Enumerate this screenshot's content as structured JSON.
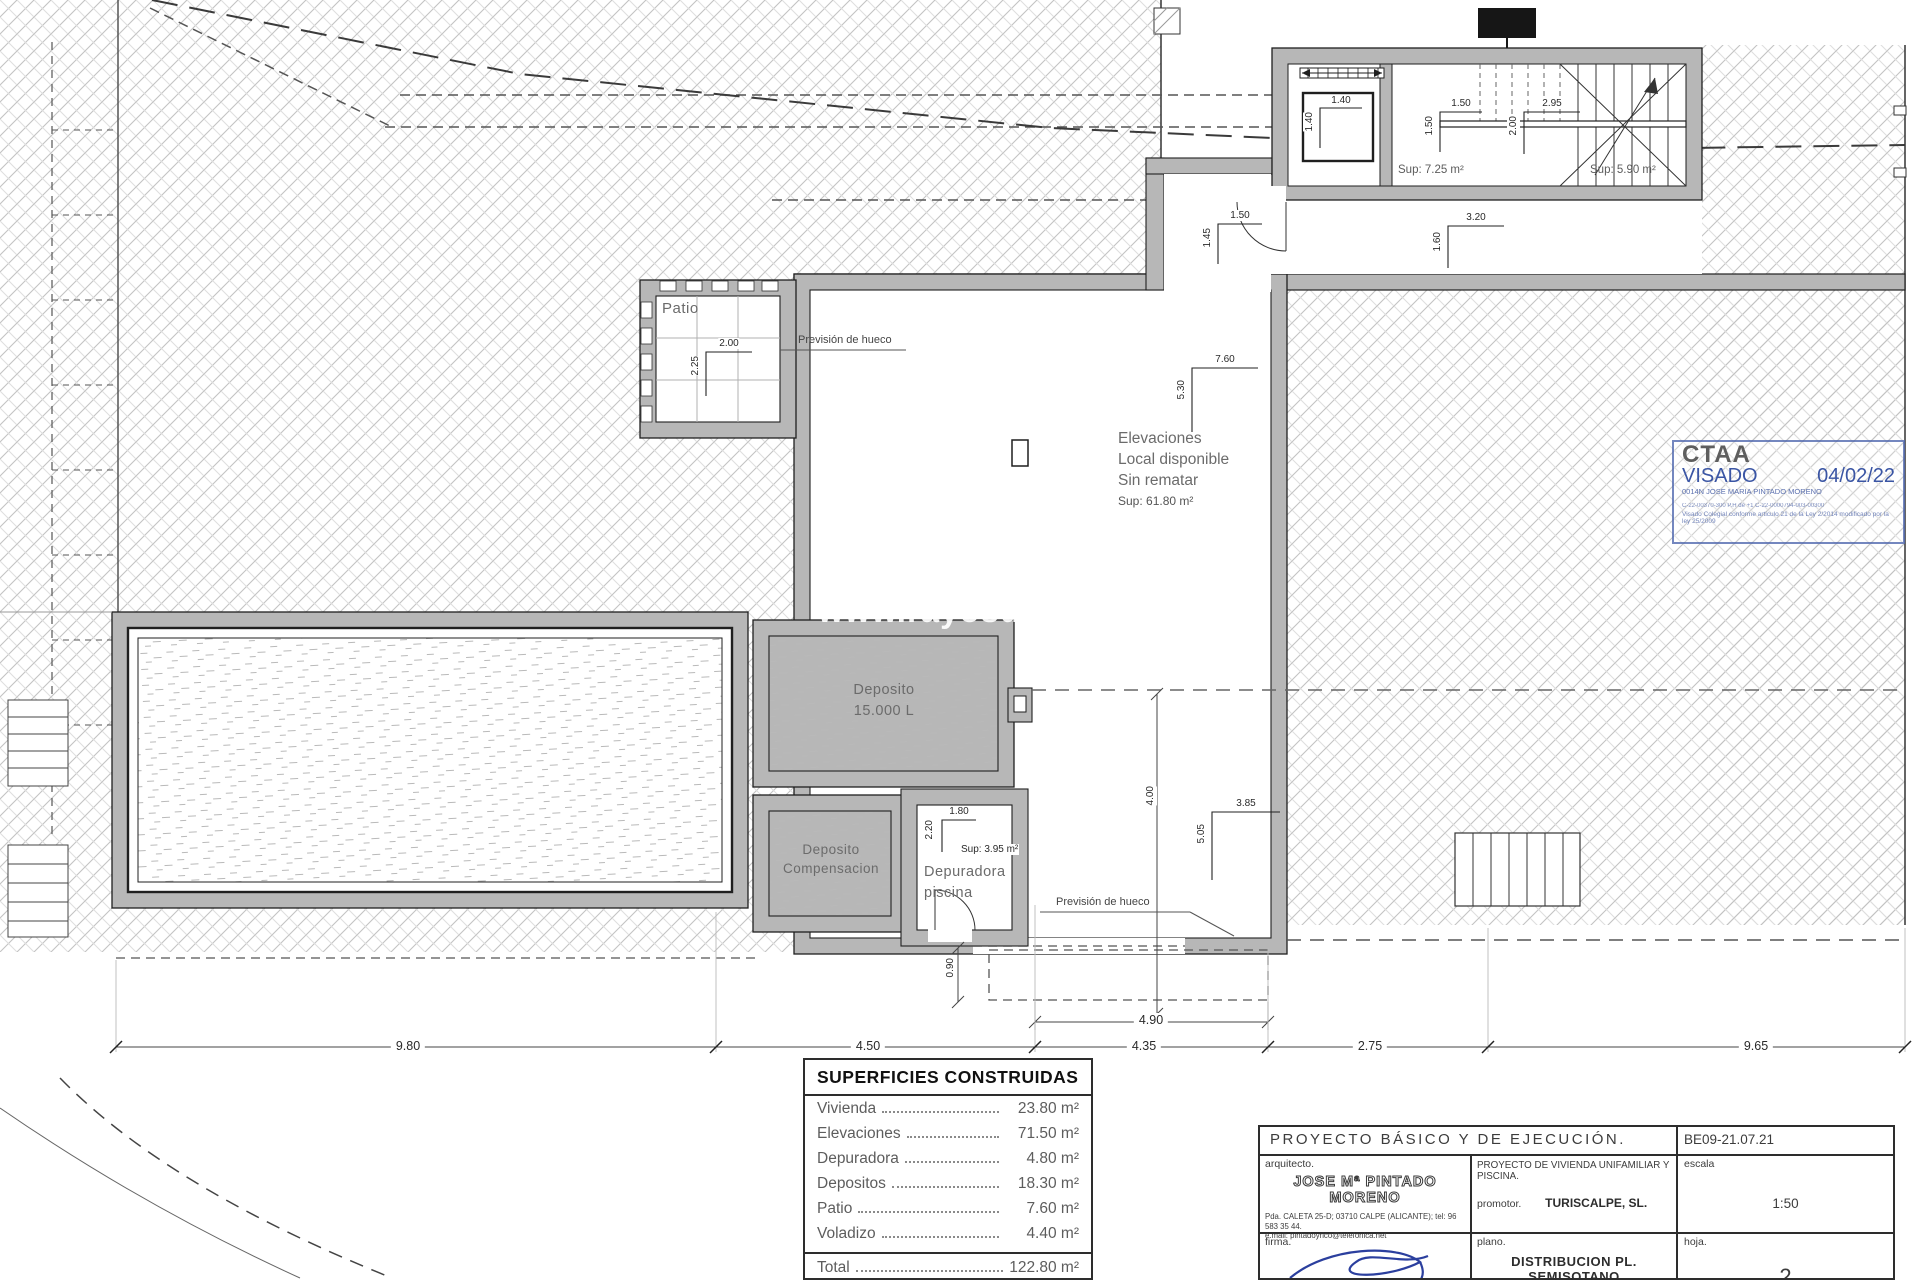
{
  "colors": {
    "wall_gray": "#b7b7b7",
    "line_dark": "#1f1f1f",
    "stamp_blue": "#3a55a4",
    "signature_blue": "#2b3f9e",
    "hatch_gray": "#c6c6c6"
  },
  "plan": {
    "watermark": "www.rayosdesol",
    "rooms": {
      "patio": "Patio",
      "prevision_top": "Previsión de hueco",
      "prevision_bottom": "Previsión de hueco",
      "elevaciones_l1": "Elevaciones",
      "elevaciones_l2": "Local disponible",
      "elevaciones_l3": "Sin rematar",
      "elevaciones_sup": "Sup: 61.80 m²",
      "ascensor_sup": "Sup: 7.25 m²",
      "escalera_sup": "Sup: 5.90 m²",
      "deposito_l1": "Deposito",
      "deposito_l2": "15.000 L",
      "comp_l1": "Deposito",
      "comp_l2": "Compensacion",
      "depuradora_l1": "Depuradora",
      "depuradora_l2": "piscina",
      "depuradora_sup": "Sup: 3.95 m²"
    },
    "dims": {
      "d140h": "1.40",
      "d140v": "1.40",
      "d150h": "1.50",
      "d150v": "1.50",
      "d295": "2.95",
      "d200v": "2.00",
      "d150door": "1.50",
      "d145": "1.45",
      "d320": "3.20",
      "d160": "1.60",
      "d200patio": "2.00",
      "d225patio": "2.25",
      "d760": "7.60",
      "d530": "5.30",
      "d400": "4.00",
      "d385": "3.85",
      "d505": "5.05",
      "d180": "1.80",
      "d220": "2.20",
      "d090": "0.90",
      "d490": "4.90",
      "d980": "9.80",
      "d450": "4.50",
      "d435": "4.35",
      "d275": "2.75",
      "d965": "9.65"
    }
  },
  "stamp": {
    "org": "CTAA",
    "visado": "VISADO",
    "date": "04/02/22",
    "name": "0014N JOSE MARIA PINTADO MORENO",
    "line1": "C-22-00370-300      P.H de +1      C-22-0000794-003-00300",
    "line2": "Visado Colegial conforme articulo 21 de la Ley 2/2014 modificado por la ley 25/2009"
  },
  "areas_table": {
    "title": "SUPERFICIES CONSTRUIDAS",
    "rows": [
      {
        "label": "Vivienda",
        "value": "23.80 m²"
      },
      {
        "label": "Elevaciones",
        "value": "71.50 m²"
      },
      {
        "label": "Depuradora",
        "value": "4.80 m²"
      },
      {
        "label": "Depositos",
        "value": "18.30 m²"
      },
      {
        "label": "Patio",
        "value": "7.60 m²"
      },
      {
        "label": "Voladizo",
        "value": "4.40 m²"
      }
    ],
    "total_label": "Total",
    "total_value": "122.80 m²"
  },
  "title_block": {
    "project": "PROYECTO  BÁSICO  Y  DE  EJECUCIÓN.",
    "code": "BE09-21.07.21",
    "arquitecto_label": "arquitecto.",
    "architect": "JOSE Mª PINTADO MORENO",
    "address": "Pda. CALETA 25-D; 03710 CALPE (ALICANTE); tel: 96 583 35 44.",
    "email": "e.mail:  pintadoyrico@telefonica.net",
    "project_desc": "PROYECTO  DE  VIVIENDA  UNIFAMILIAR  Y  PISCINA.",
    "promotor_label": "promotor.",
    "promotor": "TURISCALPE, SL.",
    "escala_label": "escala",
    "escala": "1:50",
    "firma_label": "firma.",
    "plano_label": "plano.",
    "plano": "DISTRIBUCION  PL.  SEMISOTANO",
    "hoja_label": "hoja.",
    "hoja": "2"
  }
}
